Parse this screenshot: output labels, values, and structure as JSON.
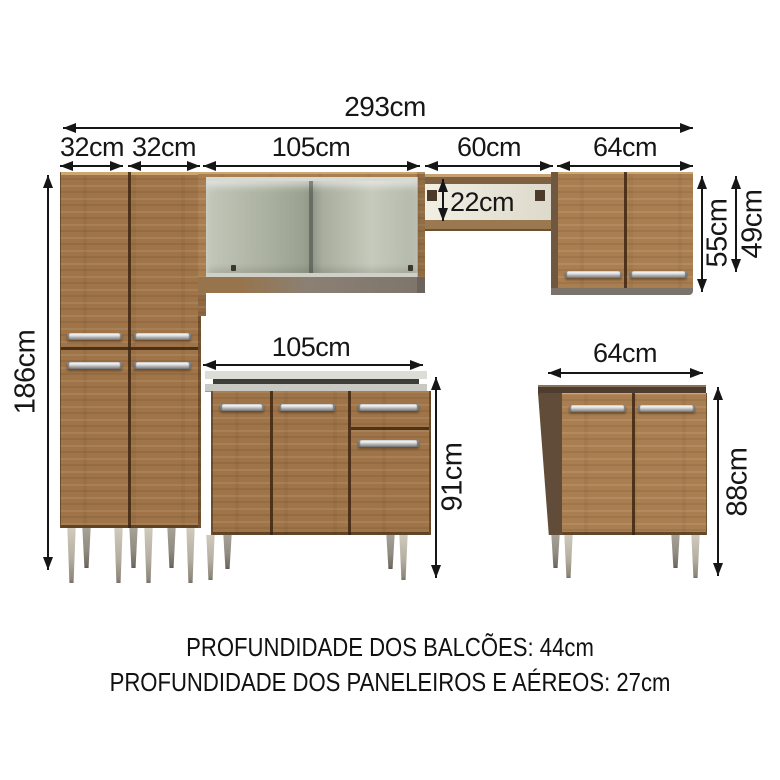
{
  "title": "Kitchen cabinet set dimension diagram",
  "dimensions": {
    "total_width": "293cm",
    "pantry_left_width": "32cm",
    "pantry_right_width": "32cm",
    "glass_aerial_width": "105cm",
    "open_shelf_width": "60cm",
    "aerial_cabinet_width": "64cm",
    "open_shelf_height": "22cm",
    "aerial_cabinet_height": "55cm",
    "aerial_door_height": "49cm",
    "pantry_height": "186cm",
    "counter_width": "105cm",
    "counter_height": "91cm",
    "base_cabinet_width": "64cm",
    "base_cabinet_height": "88cm"
  },
  "footer": {
    "line1": "PROFUNDIDADE DOS BALCÕES: 44cm",
    "line2": "PROFUNDIDADE DOS PANELEIROS E AÉREOS: 27cm"
  },
  "colors": {
    "wood": "#9e7448",
    "wood_light": "#a97f52",
    "wood_dark": "#8f6842",
    "side_panel_dark": "#5f4a38",
    "glass": "#aab09f",
    "countertop": "#dcddd6",
    "sink_rim": "#3e3e38",
    "metal_handle": "#c9c9c9",
    "leg": "#b5afa2",
    "annotation_text": "#161616",
    "background": "#ffffff"
  }
}
